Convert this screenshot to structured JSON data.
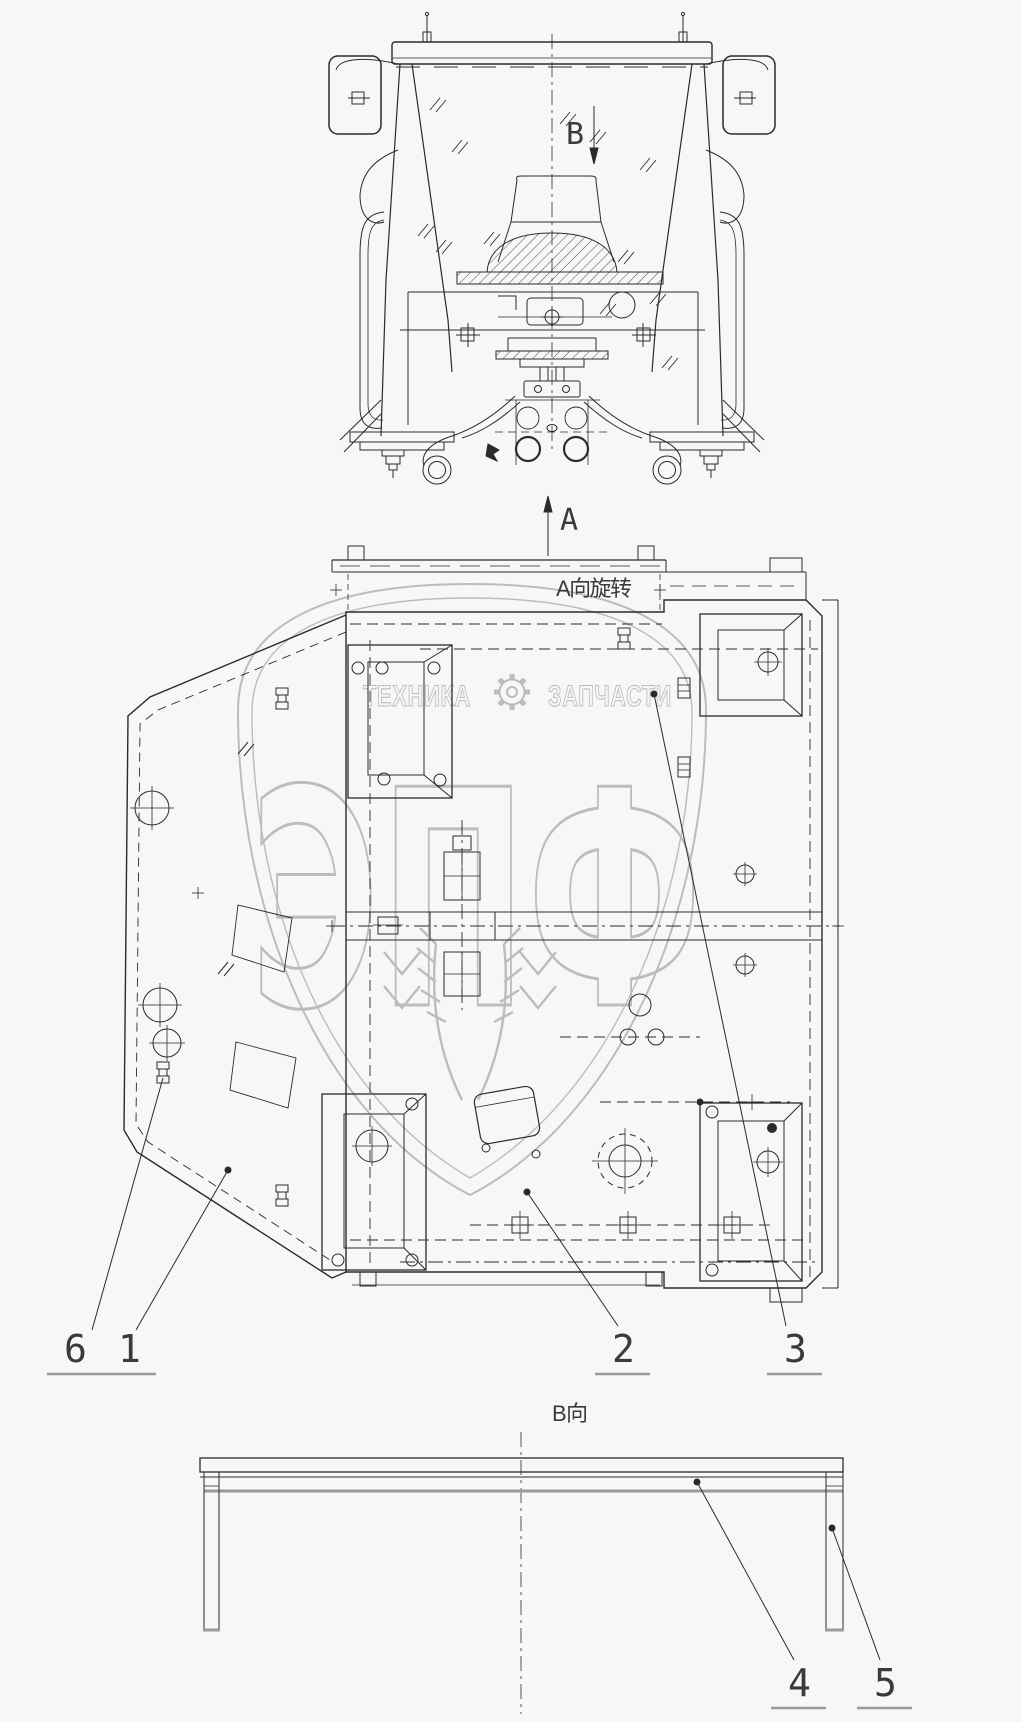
{
  "page": {
    "background": "#f7f7f5",
    "line_color": "#2b2b2b",
    "underline_color": "#9a9a9a",
    "watermark_color": "#bcbcbc"
  },
  "front_view": {
    "section_arrow_top": "B",
    "section_arrow_bottom": "A"
  },
  "plan_view": {
    "title": "A向旋转",
    "callouts": [
      {
        "number": "6"
      },
      {
        "number": "1"
      },
      {
        "number": "2"
      },
      {
        "number": "3"
      }
    ]
  },
  "bottom_view": {
    "title": "B向",
    "callouts": [
      {
        "number": "4"
      },
      {
        "number": "5"
      }
    ]
  },
  "watermark": {
    "brand_left": "ТЕХНИКА",
    "brand_right": "ЗАПЧАСТИ",
    "gear_icon": "gear-icon",
    "logo": "ЭПФ",
    "shield_icon": "shield-outline",
    "wheat_icon": "wheat-ears"
  }
}
